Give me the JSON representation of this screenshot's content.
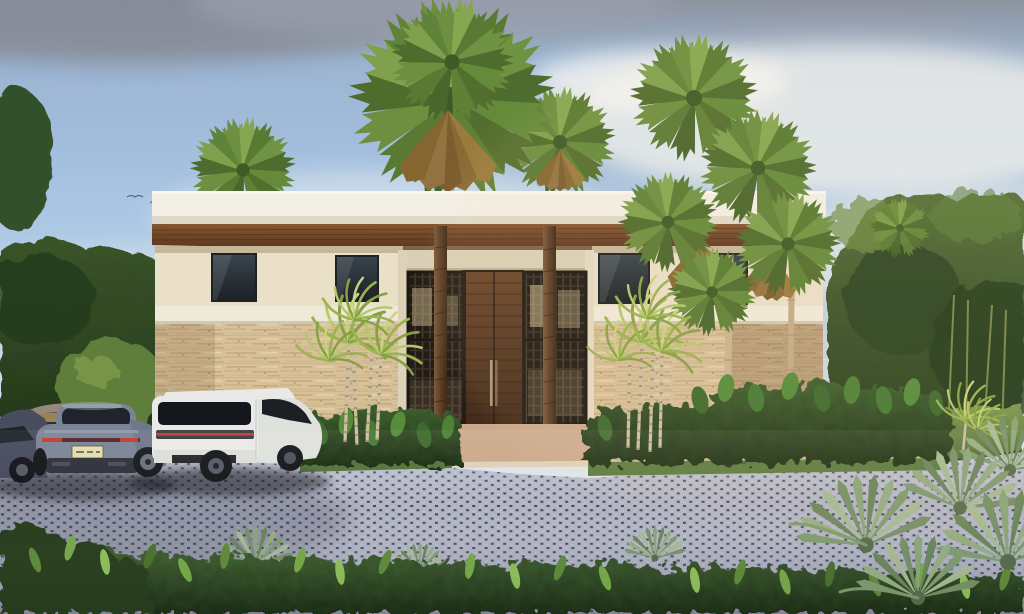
{
  "scene": {
    "type": "architectural-rendering",
    "description": "Photorealistic rendering of a modern tropical villa at dusk: flat white roof fascia over a wood soffit, cream stucco upper walls, travertine stone lower walls, a recessed entry with a tall wood pivot door flanked by dark slatted screens, fan and areca palms, a grass-grid paver driveway with a tan concrete walkway, and four parked cars.",
    "objects": [
      "evening sky with gray and white clouds",
      "background tree line left",
      "background tree line right with bamboo",
      "tall fan palms above the roof",
      "modern villa with white roof fascia",
      "wood plank soffit and porch ceiling",
      "wood pivot entry door with vertical handle",
      "dark slatted entry screens",
      "travertine stone walls",
      "cream stucco walls with dark windows",
      "areca palm clusters",
      "tropical shrub beds",
      "right side lawn",
      "grass-grid paver driveway",
      "tan concrete entry walkway",
      "dark violet sedan",
      "gray sedan",
      "blue-gray Porsche 911 with lit license plate",
      "white Range Rover Velar",
      "blue-green fan palm cluster foreground",
      "leafy shrub band foreground",
      "small birds in the sky"
    ]
  },
  "palette": {
    "sky_top": "#8e939f",
    "sky_mid": "#a9c6e4",
    "sky_low": "#e7ebee",
    "cloud_gray": "#878c98",
    "cloud_white": "#f3f4f2",
    "fascia_white": "#f2efe5",
    "wall_cream": "#eadfc7",
    "parapet_white": "#efe9d9",
    "stone_beige": "#d8c099",
    "soffit_wood": "#6e4527",
    "door_top": "#6b452a",
    "door_bottom": "#422b1a",
    "screen_dark": "#211b16",
    "window_glass": "#2b3238",
    "paver_gray": "#b0b3c3",
    "paver_dot": "#3f4457",
    "walkway_tan": "#cba98c",
    "curb_light": "#ded2b9",
    "grass_green": "#638240",
    "shrub_dark": "#2f4c22",
    "tree_dark": "#2c4423",
    "palm_green": "#65883a",
    "palm_dry": "#96763a",
    "areca_green": "#9cb352",
    "trunk_tan": "#cbb492",
    "porsche_gray": "#7b8496",
    "velar_white": "#e9eae7",
    "sedan_dark": "#474c5e",
    "taillight_red": "#c23b34",
    "plate_yellow": "#e3dead"
  }
}
